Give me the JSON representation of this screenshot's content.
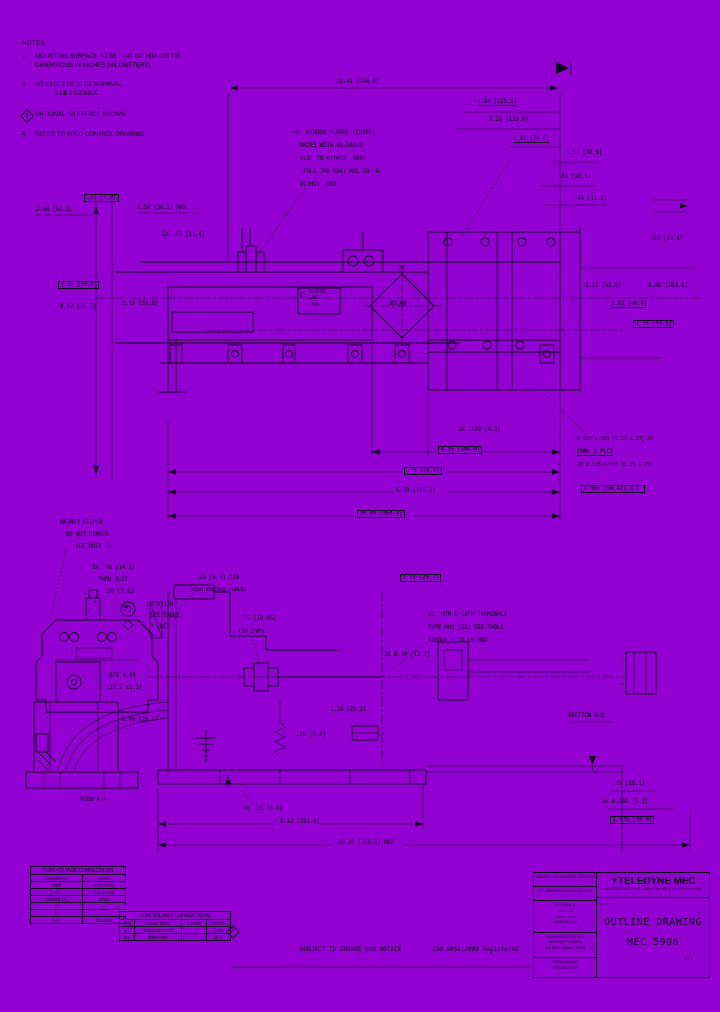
{
  "colors": {
    "bg": "#9301D2",
    "ink": "#120020"
  },
  "notes": {
    "heading": "NOTES:",
    "items": [
      {
        "num": "1.",
        "diamond": false,
        "lines": [
          "MOUNTING SURFACE TO BE FLAT WITHIN .005 TIR,",
          "DIMENSIONS IN INCHES [MILLIMETERS]."
        ]
      },
      {
        "num": "2.",
        "diamond": false,
        "lines": [
          "WEIGHT: 2 LB 10 OZ NOMINAL",
          "3 LB 2 OZ MAX"
        ]
      },
      {
        "num": "3",
        "diamond": true,
        "lines": [
          "OPTIONAL INTERFACE SHOWN"
        ]
      },
      {
        "num": "4.",
        "diamond": false,
        "lines": [
          "REFER TO SPEC CONTROL DRAWING."
        ]
      }
    ]
  },
  "labels": [
    {
      "t": "10.43 [264.9]",
      "x": 336,
      "y": 79
    },
    {
      "t": "4.94 [125.5]",
      "x": 477,
      "y": 99,
      "ul": 1
    },
    {
      "t": "5.26 [133.6]",
      "x": 489,
      "y": 117
    },
    {
      "t": "2.97 [75.5]",
      "x": 513,
      "y": 136,
      "ul": 1
    },
    {
      "t": "1.52 [38.6]",
      "x": 566,
      "y": 150
    },
    {
      "t": ".81 [20.5]",
      "x": 558,
      "y": 174
    },
    {
      "t": ".44 [11.2]",
      "x": 574,
      "y": 196
    },
    {
      "t": ".31 [7.9]",
      "x": 84,
      "y": 194,
      "box": 1
    },
    {
      "t": "2.06 [52.3]",
      "x": 36,
      "y": 207
    },
    {
      "t": "1.50 [38.1] MAX",
      "x": 137,
      "y": 205
    },
    {
      "t": "2X .45 [11.4]",
      "x": 162,
      "y": 232
    },
    {
      "t": "1.18 [30.0]",
      "x": 58,
      "y": 281,
      "box": 1
    },
    {
      "t": "Ø.62 [15.7]",
      "x": 60,
      "y": 304
    },
    {
      "t": "2.03 [51.6]",
      "x": 122,
      "y": 301
    },
    {
      "t": "2.12 [53.8]",
      "x": 585,
      "y": 283
    },
    {
      "t": "4.06 [103.1]",
      "x": 648,
      "y": 283
    },
    {
      "t": "1.81 [46.0]",
      "x": 611,
      "y": 301,
      "ul": 1
    },
    {
      "t": "1.75 [44.5]",
      "x": 633,
      "y": 320,
      "box": 1
    },
    {
      "t": ".88 [22.4]",
      "x": 650,
      "y": 236
    },
    {
      "t": "-C- WINDOW FLANGE (COVER)",
      "x": 293,
      "y": 130
    },
    {
      "t": "MATES WITH UG-584/U",
      "x": 300,
      "y": 143
    },
    {
      "t": "FLAT TO WITHIN .0005",
      "x": 300,
      "y": 156
    },
    {
      "t": "(FULL IND RDG) REL TO -B-",
      "x": 300,
      "y": 169
    },
    {
      "t": "WITHIN .002",
      "x": 300,
      "y": 182
    },
    {
      "t": ".75",
      "x": 396,
      "y": 266,
      "fs": 5
    },
    {
      "t": "Ø1.00",
      "x": 390,
      "y": 301
    },
    {
      "t": "2X .193 [4.9]",
      "x": 458,
      "y": 427
    },
    {
      "t": "4.25 [108.0]",
      "x": 438,
      "y": 446,
      "box": 1
    },
    {
      "t": ".75 [19.1]",
      "x": 404,
      "y": 467,
      "box": 1
    },
    {
      "t": "6.50 [165.1]",
      "x": 396,
      "y": 488
    },
    {
      "t": "10.40 [264.2]",
      "x": 357,
      "y": 510,
      "box": 1
    },
    {
      "t": "Ø.320 ±.005 [8.13 ±.13] 2X",
      "x": 577,
      "y": 437,
      "fs": 5.2
    },
    {
      "t": "THRU 2 PLCS",
      "x": 577,
      "y": 449,
      "ul": 1
    },
    {
      "t": "2X Ø.128 +.010 [3.25 +.25]",
      "x": 577,
      "y": 463,
      "fs": 5.2
    },
    {
      "t": "2.300 [58.42] B.C.",
      "x": 581,
      "y": 485,
      "box": 1
    },
    {
      "t": "TELEDYNE",
      "x": 308,
      "y": 290,
      "fs": 4,
      "n": "nameplate-line"
    },
    {
      "t": "MEC",
      "x": 312,
      "y": 296,
      "fs": 4,
      "n": "nameplate-line"
    },
    {
      "t": "USA",
      "x": 312,
      "y": 303,
      "fs": 4,
      "n": "nameplate-line"
    },
    {
      "t": "MAGNET KEEPER",
      "x": 60,
      "y": 520
    },
    {
      "t": "DO NOT REMOVE",
      "x": 66,
      "y": 532
    },
    {
      "t": "(SEE NOTE 3)",
      "x": 72,
      "y": 544
    },
    {
      "t": "2X .56 [14.2]",
      "x": 92,
      "y": 565
    },
    {
      "t": "THRU SLOT",
      "x": 98,
      "y": 577
    },
    {
      "t": ".30 [7.6]",
      "x": 104,
      "y": 589
    },
    {
      "t": "MHV",
      "x": 121,
      "y": 606,
      "fs": 4.4
    },
    {
      "t": "UG-931/U",
      "x": 147,
      "y": 602
    },
    {
      "t": "SEE TABLE",
      "x": 150,
      "y": 613
    },
    {
      "t": "2 PLCS",
      "x": 150,
      "y": 624
    },
    {
      "t": ".25 [6.4] DIA",
      "x": 196,
      "y": 575
    },
    {
      "t": "(HIGH VOLTAGE CABLE)",
      "x": 188,
      "y": 588,
      "fs": 5.2
    },
    {
      "t": ".75 [19.05]",
      "x": 240,
      "y": 616
    },
    {
      "t": "(2X TYP)",
      "x": 238,
      "y": 629
    },
    {
      "t": "E1, HTR & CATH TERMINALS",
      "x": 428,
      "y": 612
    },
    {
      "t": "TYPE MHV (2X) SEE TABLE",
      "x": 428,
      "y": 625
    },
    {
      "t": "TORQUE 8 IN-LB MAX",
      "x": 428,
      "y": 638
    },
    {
      "t": "1.13 [28.7]",
      "x": 400,
      "y": 574,
      "box": 1
    },
    {
      "t": "2X Ø.50 [12.7]",
      "x": 384,
      "y": 652
    },
    {
      "t": ".875 ±.05",
      "x": 106,
      "y": 673
    },
    {
      "t": "[22.2 ±1.3]",
      "x": 106,
      "y": 685
    },
    {
      "t": "1.00 [25.4]",
      "x": 122,
      "y": 717
    },
    {
      "t": "SECTION B-B",
      "x": 568,
      "y": 713
    },
    {
      "t": "1.15 [29.2]",
      "x": 330,
      "y": 707
    },
    {
      "t": ".29 [7.4]",
      "x": 296,
      "y": 732
    },
    {
      "t": "VIEW A-A",
      "x": 80,
      "y": 797
    },
    {
      "t": "4X .25 [6.4]",
      "x": 243,
      "y": 806
    },
    {
      "t": "9.12 [231.6]",
      "x": 280,
      "y": 819
    },
    {
      "t": "10.20 [259.1] MAX",
      "x": 338,
      "y": 840
    },
    {
      "t": ".75 [19.1]",
      "x": 612,
      "y": 781
    },
    {
      "t": "2X Ø.203 [5.2]",
      "x": 602,
      "y": 799
    },
    {
      "t": "1.375 [34.9]",
      "x": 610,
      "y": 816,
      "box": 1
    },
    {
      "t": "3",
      "x": 231,
      "y": 929,
      "fs": 5,
      "n": "table-note-number"
    }
  ],
  "hv_table": {
    "title": "HIGH VOLTAGE CONNECTIONS",
    "columns": [
      "TERMINAL",
      "DESIG"
    ],
    "rows": [
      [
        "HTR",
        "#20 AWG"
      ],
      [
        "CATH",
        "YELLOW"
      ],
      [
        "ANODE (A)",
        "GND"
      ],
      [
        "K",
        "—"
      ],
      [
        "F",
        "—"
      ],
      [
        "(A)",
        "(CASE)"
      ]
    ]
  },
  "lv_table": {
    "title": "LOW VOLTAGE CONNECTIONS",
    "columns": [
      "PIN",
      "FUNCTION",
      "V MAX",
      "DESIG"
    ],
    "rows": [
      [
        "E1",
        "THERMISTOR",
        "·",
        "GRN"
      ],
      [
        "E2",
        "GROUND",
        "·",
        "BLK"
      ]
    ]
  },
  "title_block": {
    "logo_glyph": "▼",
    "brand": "TELEDYNE MEC",
    "address": "1274 TERRA BELLA AVE., MOUNTAIN VIEW, CALIFORNIA 94043",
    "title_label": "TITLE:",
    "doc_title": "OUTLINE DRAWING",
    "part_number": "MEC 5906",
    "left_rows": [
      {
        "lines": [
          "UNLESS OTHERWISE SPECIFIED"
        ]
      },
      {
        "lines": [
          "ALL DIMENSIONS IN INCHES"
        ]
      },
      {
        "lines": [
          "DECIMALS",
          ".XX ± .03",
          ".XXX ± .010",
          "ANGLES ± 2°"
        ]
      },
      {
        "lines": [
          "TOLERANCES APPLY",
          "BEFORE PLATING",
          "DO NOT SCALE DWG"
        ]
      },
      {
        "lines": [
          "THIRD ANGLE",
          "PROJECTION"
        ]
      }
    ]
  },
  "footer": {
    "change_notice": "SUBJECT TO CHANGE W/O NOTICE",
    "iso": "ISO 9001:2000 Registered",
    "scale": "1:2"
  }
}
